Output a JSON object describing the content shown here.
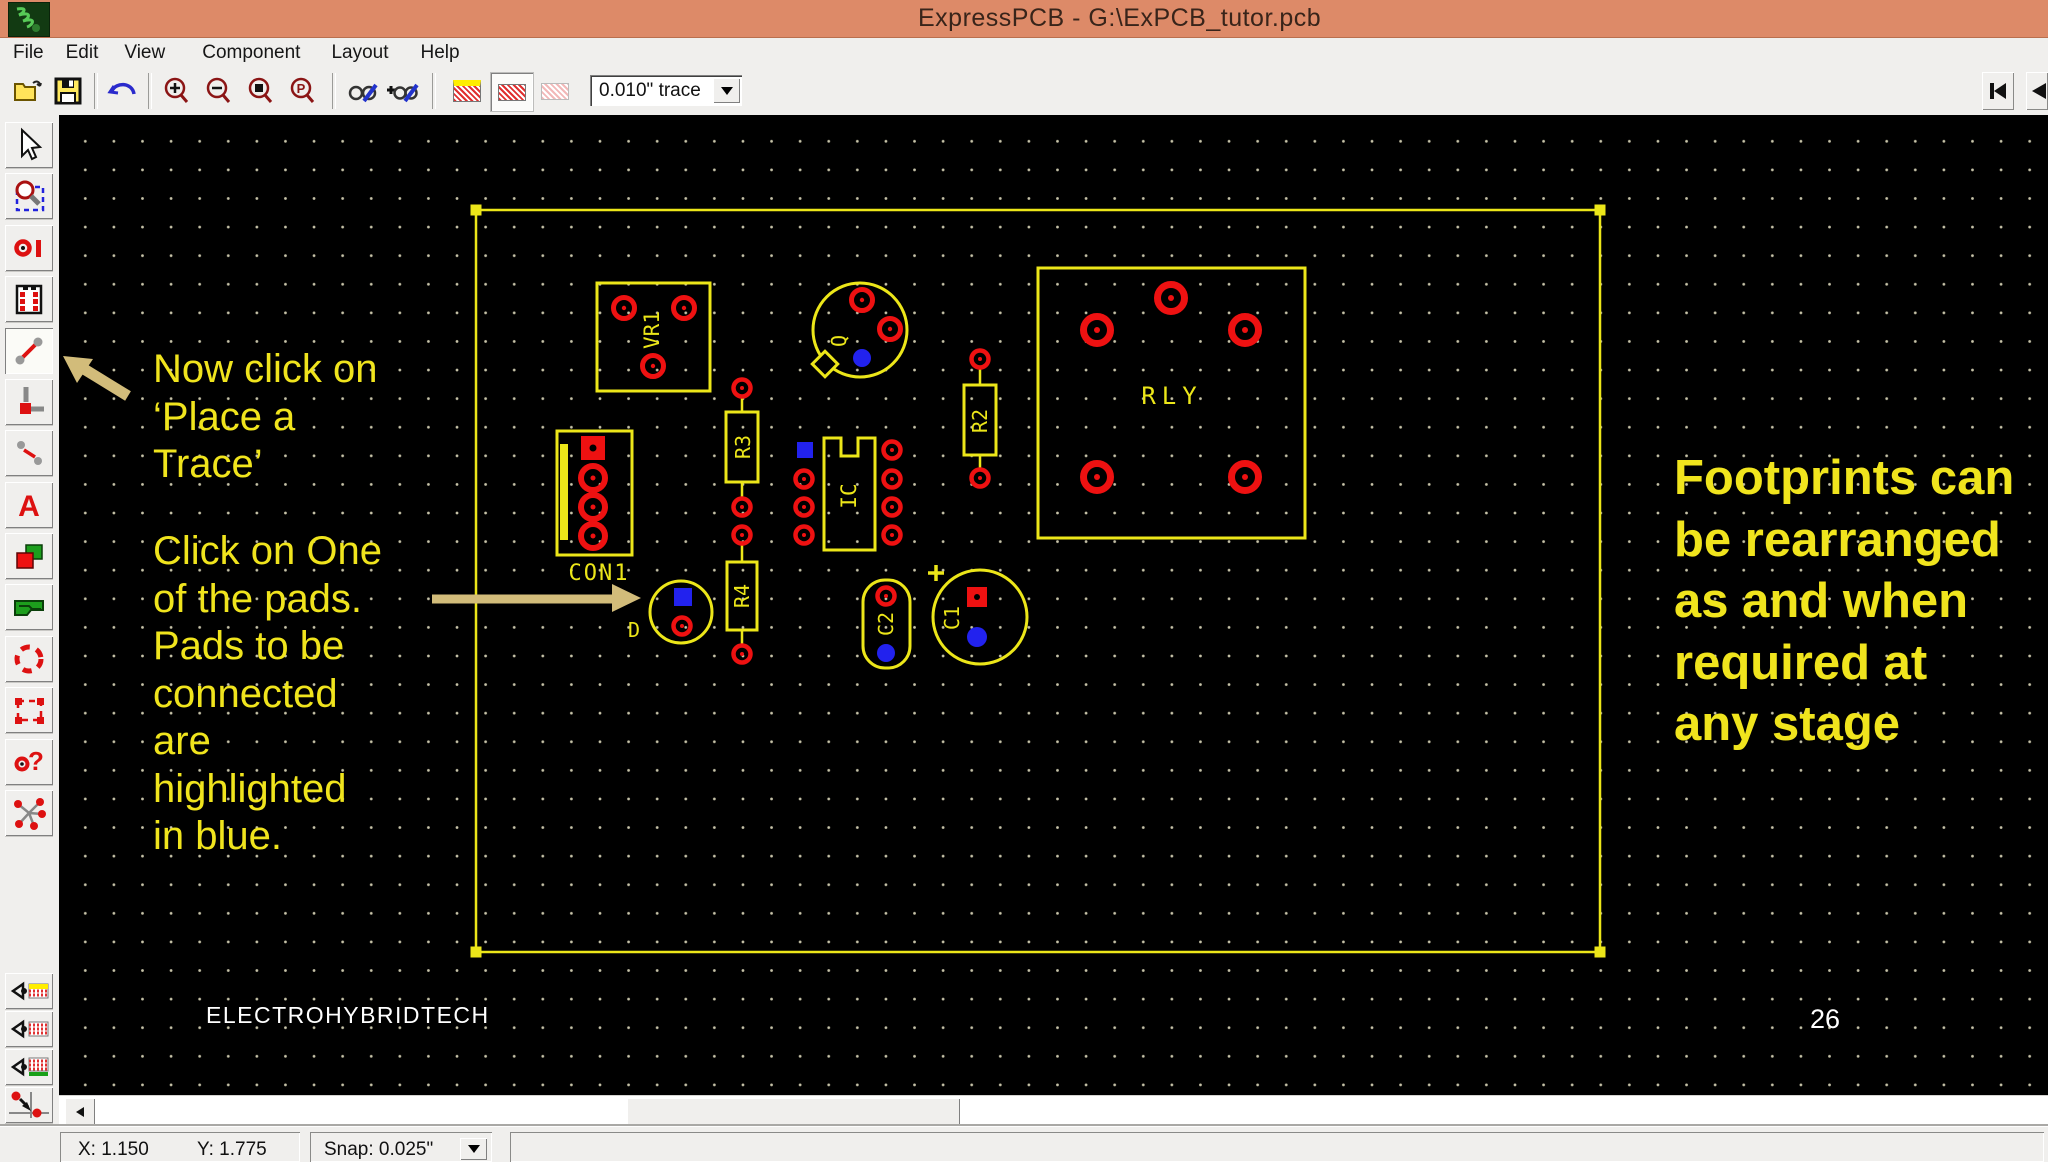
{
  "window": {
    "title": "ExpressPCB - G:\\ExPCB_tutor.pcb",
    "titlebar_color": "#dd8a68"
  },
  "menu": {
    "items": [
      "File",
      "Edit",
      "View",
      "Component",
      "Layout",
      "Help"
    ]
  },
  "toolbar": {
    "trace_width": "0.010\" trace",
    "icons": [
      "open-icon",
      "save-icon",
      "undo-icon",
      "zoom-in-icon",
      "zoom-out-icon",
      "zoom-board-icon",
      "zoom-previous-icon",
      "component-manager-icon",
      "component-add-icon",
      "layer-silkscreen-swatch",
      "layer-top-copper-swatch",
      "layer-bottom-copper-swatch",
      "first-page-icon",
      "previous-page-icon"
    ]
  },
  "palette": {
    "icons": [
      "select-icon",
      "zoom-select-icon",
      "pad-icon",
      "component-icon",
      "place-trace-icon",
      "place-corner-icon",
      "place-segment-icon",
      "text-icon",
      "rectangle-icon",
      "plane-icon",
      "circle-icon",
      "group-select-icon",
      "pad-info-icon",
      "ratsnest-icon",
      "layer-silkscreen-icon",
      "layer-top-copper-icon",
      "layer-bottom-copper-icon",
      "origin-snap-icon"
    ],
    "active_tool": "place-trace"
  },
  "canvas": {
    "notes": {
      "place_trace": "Now click on\n‘Place a\nTrace’",
      "pads": "Click on One\nof the pads.\nPads to be\nconnected\nare\nhighlighted\nin blue.",
      "footprints": "Footprints can\nbe rearranged\nas and when\nrequired at\nany stage"
    },
    "watermark": "ELECTROHYBRIDTECH",
    "page_number": "26",
    "components": {
      "vr1": "VR1",
      "q": "Q",
      "rly": "RLY",
      "r2": "R2",
      "r3": "R3",
      "r4": "R4",
      "ic": "IC",
      "con1": "CON1",
      "d": "D",
      "c2": "C2",
      "c1": "C1"
    },
    "colors": {
      "board_outline": "#ece619",
      "pad_red": "#ee1111",
      "highlight_blue": "#2222ee",
      "annotation_yellow": "#f0e41d",
      "arrow_khaki": "#d2bc7a",
      "grid_dot": "#d2ceb2"
    }
  },
  "statusbar": {
    "x": "X: 1.150",
    "y": "Y: 1.775",
    "snap": "Snap: 0.025\""
  }
}
